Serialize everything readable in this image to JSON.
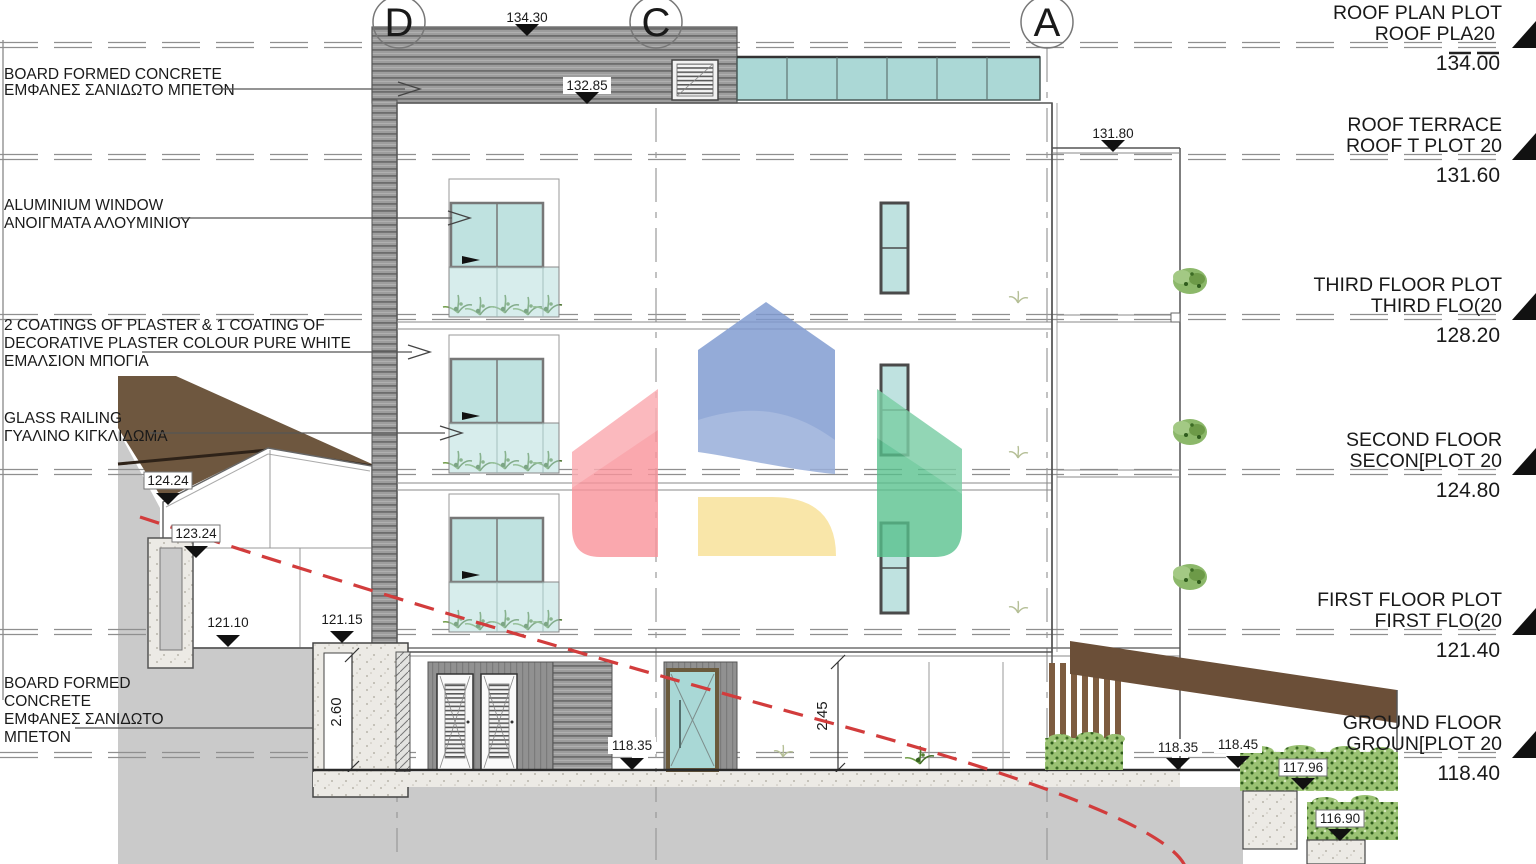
{
  "drawing": {
    "title_context": "building elevation / section drawing",
    "left_annotations": [
      {
        "lines": [
          "BOARD FORMED CONCRETE",
          "ΕΜΦΑΝΕΣ ΣΑΝΙΔΩΤΟ ΜΠΕΤΟΝ"
        ]
      },
      {
        "lines": [
          "ALUMINIUM WINDOW",
          "ΑΝΟΙΓΜΑΤΑ ΑΛΟΥΜΙΝΙΟΥ"
        ]
      },
      {
        "lines": [
          "2 COATINGS OF PLASTER & 1 COATING OF",
          "DECORATIVE PLASTER COLOUR PURE WHITE",
          "ΕΜΑΛΣΙΟΝ ΜΠΟΓΙΑ"
        ]
      },
      {
        "lines": [
          "GLASS RAILING",
          "ΓΥΑΛΙΝΟ ΚΙΓΚΛΙΔΩΜΑ"
        ]
      },
      {
        "lines": [
          "BOARD FORMED",
          "CONCRETE",
          "ΕΜΦΑΝΕΣ ΣΑΝΙΔΩΤΟ",
          "ΜΠΕΤΟΝ"
        ]
      }
    ],
    "grid_bubbles": [
      {
        "label": "D"
      },
      {
        "label": "C"
      },
      {
        "label": "A"
      }
    ],
    "levels": [
      {
        "line1": "ROOF PLAN PLOT",
        "line2": "ROOF PLA20",
        "value": "134.00"
      },
      {
        "line1": "ROOF TERRACE",
        "line2": "ROOF T PLOT 20",
        "value": "131.60"
      },
      {
        "line1": "THIRD FLOOR PLOT",
        "line2": "THIRD FLO(20",
        "value": "128.20"
      },
      {
        "line1": "SECOND FLOOR",
        "line2": "SECON[PLOT 20",
        "value": "124.80"
      },
      {
        "line1": "FIRST FLOOR PLOT",
        "line2": "FIRST FLO(20",
        "value": "121.40"
      },
      {
        "line1": "GROUND FLOOR",
        "line2": "GROUN[PLOT 20",
        "value": "118.40"
      }
    ],
    "spot_elevations": [
      "134.30",
      "132.85",
      "131.80",
      "124.24",
      "123.24",
      "121.10",
      "121.15",
      "118.35",
      "118.35",
      "118.45",
      "117.96",
      "116.90"
    ],
    "dimensions": [
      {
        "value": "2.60"
      },
      {
        "value": "2.45"
      }
    ],
    "watermark": {
      "blue": "#7d98cf",
      "red": "#f9929a",
      "green": "#56c08c",
      "yellow": "#f8e29a"
    },
    "colors": {
      "terrain_brown": "#6e573f",
      "ground_gray": "#cacaca",
      "glass_teal": "#bfe2e0",
      "hedge_green": "#95bd72",
      "section_line_red": "#d23c3c"
    }
  }
}
